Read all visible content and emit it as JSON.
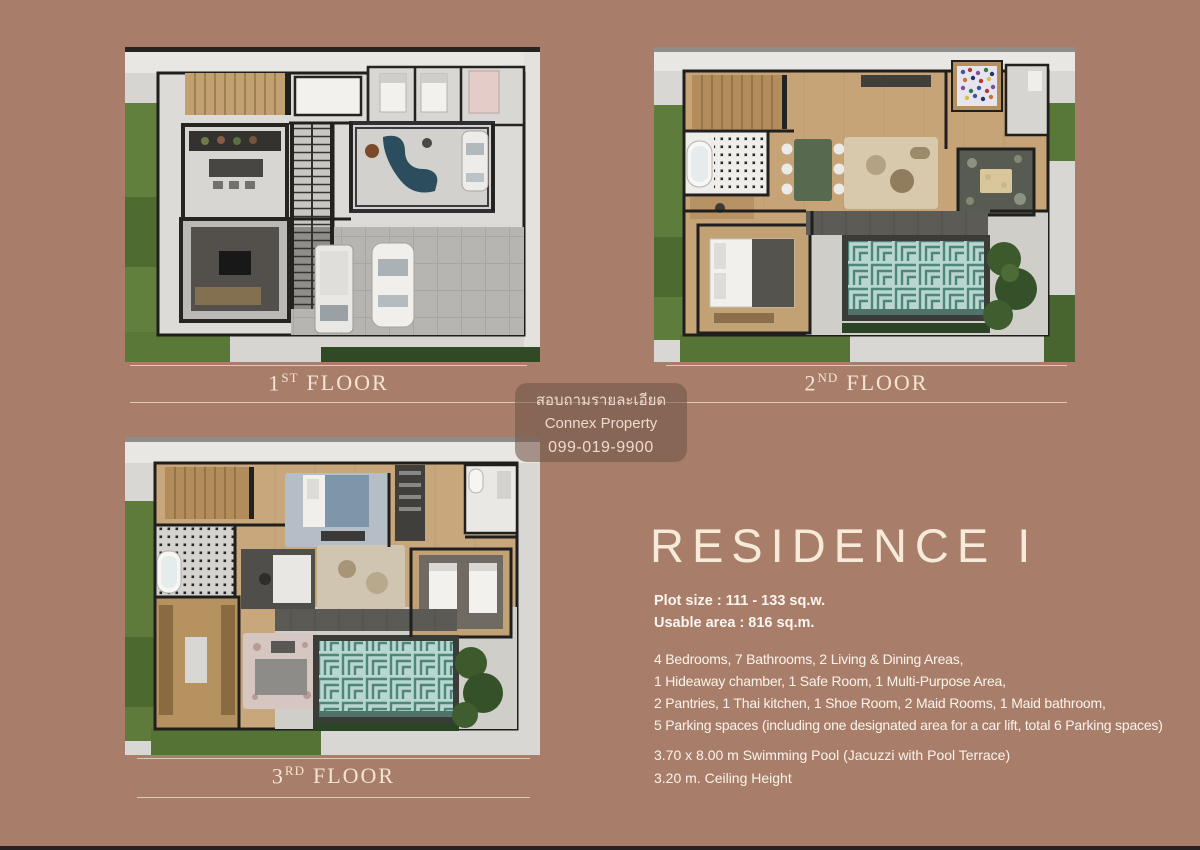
{
  "palette": {
    "background": "#a87e6b",
    "cream_text": "#f3e5d2",
    "body_text": "#fbf3ea",
    "divider_line": "#e8d6c5",
    "watermark_bg": "rgba(113,84,71,0.58)",
    "pool_teal": "#4f867b",
    "pool_aqua": "#b9d7d0",
    "lawn_green": "#5e7c3b",
    "wall_black": "#1f1e1d",
    "wood_tan": "#c6a478",
    "bottom_bar": "#272121"
  },
  "floor_plans": [
    {
      "label_number": "1",
      "label_ordinal": "ST",
      "label_word": "FLOOR"
    },
    {
      "label_number": "2",
      "label_ordinal": "ND",
      "label_word": "FLOOR"
    },
    {
      "label_number": "3",
      "label_ordinal": "RD",
      "label_word": "FLOOR"
    }
  ],
  "watermark": {
    "line1": "สอบถามรายละเอียด",
    "line2": "Connex Property",
    "line3": "099-019-9900"
  },
  "residence": {
    "title": "RESIDENCE I",
    "specs": [
      "Plot size : 111 - 133 sq.w.",
      "Usable area : 816 sq.m."
    ],
    "features": [
      "4 Bedrooms, 7 Bathrooms, 2 Living & Dining Areas,",
      "1 Hideaway chamber, 1 Safe Room, 1 Multi-Purpose Area,",
      "2 Pantries, 1 Thai kitchen, 1 Shoe Room, 2 Maid Rooms, 1 Maid bathroom,",
      "5 Parking spaces (including one designated area for a car lift, total 6 Parking spaces)"
    ],
    "extras": [
      "3.70 x 8.00 m Swimming Pool (Jacuzzi with Pool Terrace)",
      "3.20 m. Ceiling Height"
    ]
  }
}
